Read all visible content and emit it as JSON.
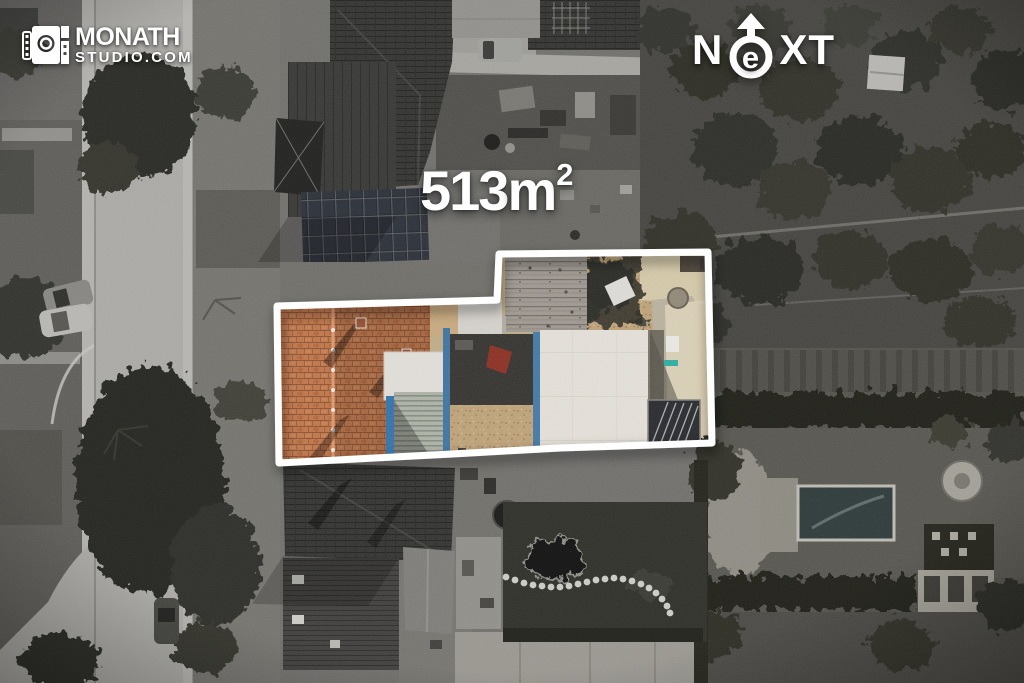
{
  "branding": {
    "studio_logo": {
      "icon": "camera-icon",
      "line1": "MONATH",
      "line2": "STUDIO.COM"
    },
    "next_logo": {
      "icon": "north-arrow-icon",
      "prefix": "N",
      "circle_letter": "e",
      "suffix": "XT"
    }
  },
  "property": {
    "area_text": "513m²",
    "area_value": "513",
    "area_unit": "m",
    "area_superscript": "2",
    "outline_color": "#ffffff"
  },
  "scene": {
    "colors": {
      "street": "#a8a7a3",
      "dark_roofs": "#343432",
      "brick_roof": "#b96f45",
      "wood_deck": "#98918a",
      "concrete": "#d9d6d0",
      "gravel": "#b89c72",
      "accent_blue": "#3a6d9a",
      "accent_red": "#8d2b20",
      "accent_teal": "#2ba79a",
      "pond": "#161616"
    }
  }
}
